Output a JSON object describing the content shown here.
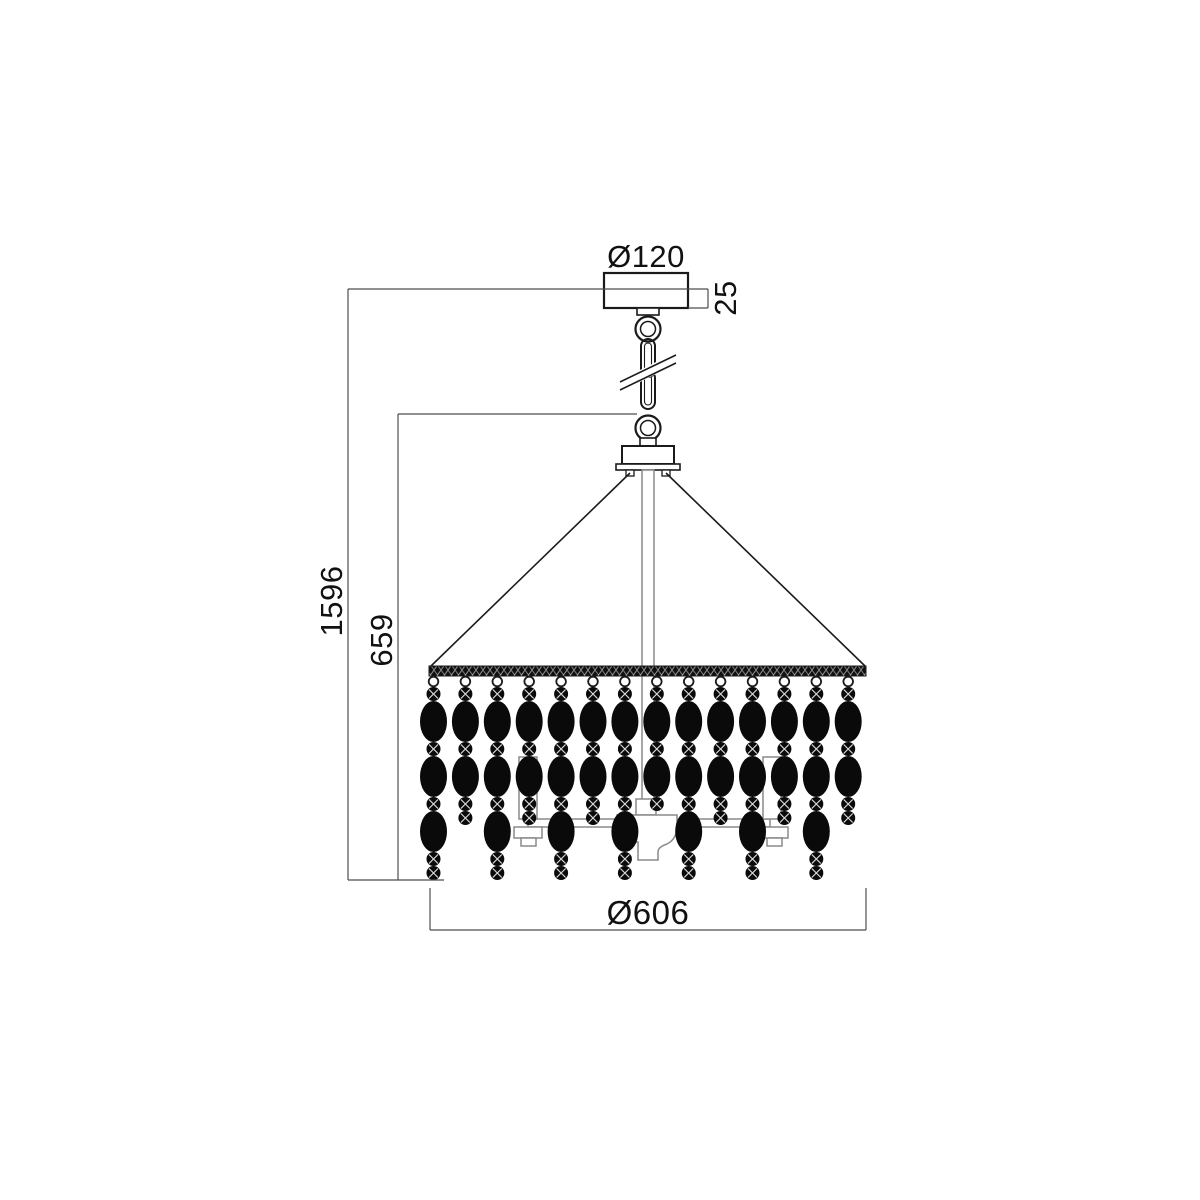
{
  "figure": {
    "type": "technical-dimension-drawing",
    "subject": "pendant chandelier with beaded crystal strands, side elevation",
    "dimensions": {
      "canopy_diameter_label": "Ø120",
      "canopy_height_label": "25",
      "overall_height_label": "1596",
      "body_height_label": "659",
      "body_diameter_label": "Ø606"
    },
    "colors": {
      "outline": "#1a1a1a",
      "frame": "#8a8a8a",
      "bead": "#0a0a0a",
      "dimension_line": "#4d4d4d",
      "text": "#111111",
      "background": "#ffffff"
    },
    "strands": {
      "count": 14,
      "x_start": 433.5,
      "x_step": 31.9,
      "loop_cy": 681.5,
      "loop_radius": 4.8,
      "start_y": 687,
      "small_radius": 7,
      "oval_rx": 13.5,
      "oval_ry": 20.5,
      "types": [
        "long",
        "short",
        "long",
        "short",
        "long",
        "short",
        "long",
        "short-trimmed",
        "long",
        "short",
        "long",
        "short",
        "long",
        "short"
      ],
      "sequences": {
        "long": [
          "small",
          "oval",
          "small",
          "oval",
          "small",
          "oval",
          "small",
          "small"
        ],
        "short": [
          "small",
          "oval",
          "small",
          "oval",
          "small",
          "small"
        ],
        "short-trimmed": [
          "small",
          "oval",
          "small",
          "oval",
          "small"
        ]
      }
    }
  }
}
